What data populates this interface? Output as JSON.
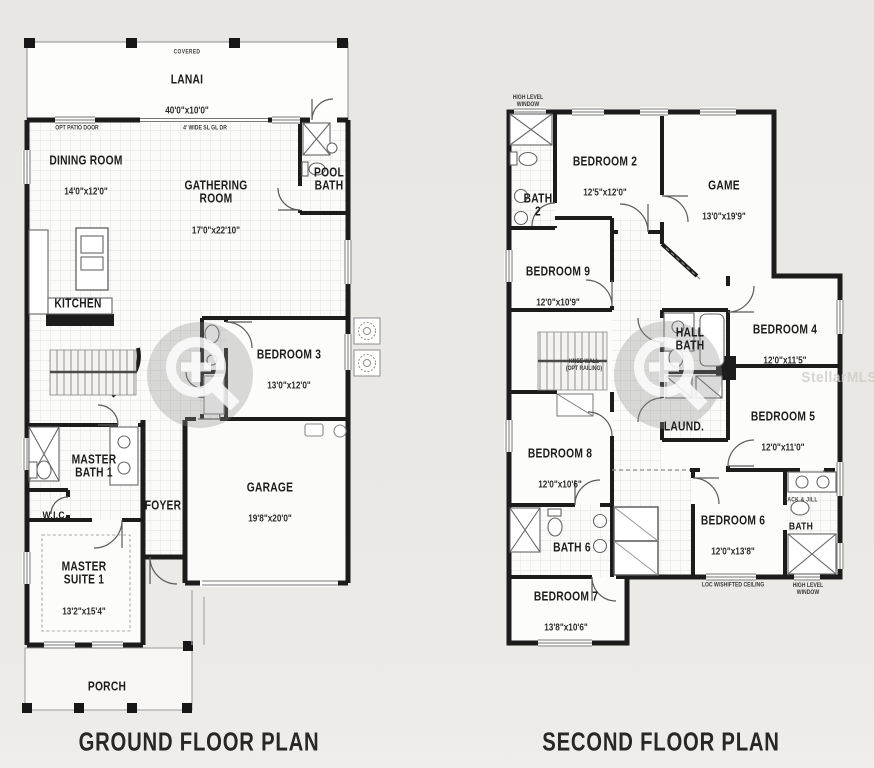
{
  "watermark": {
    "source_label": "StellarMLS"
  },
  "ground_floor": {
    "title": "GROUND FLOOR PLAN",
    "rooms": {
      "lanai": {
        "note": "COVERED",
        "name": "LANAI",
        "dims": "40'0\"x10'0\""
      },
      "dining": {
        "name": "DINING ROOM",
        "dims": "14'0\"x12'0\""
      },
      "gathering": {
        "name": "GATHERING\nROOM",
        "dims": "17'0\"x22'10\""
      },
      "pool_bath": {
        "name": "POOL\nBATH"
      },
      "kitchen": {
        "name": "KITCHEN"
      },
      "bedroom3": {
        "name": "BEDROOM 3",
        "dims": "13'0\"x12'0\""
      },
      "master_bath": {
        "name": "MASTER\nBATH 1"
      },
      "wic": {
        "name": "W.I.C."
      },
      "foyer": {
        "name": "FOYER"
      },
      "garage": {
        "name": "GARAGE",
        "dims": "19'8\"x20'0\""
      },
      "master_suite": {
        "name": "MASTER\nSUITE 1",
        "dims": "13'2\"x15'4\""
      },
      "porch": {
        "name": "PORCH"
      }
    },
    "annotations": {
      "opt_patio_door": "OPT PATIO DOOR",
      "sl_glass_door": "4' WIDE SL GL DR"
    }
  },
  "second_floor": {
    "title": "SECOND FLOOR PLAN",
    "rooms": {
      "bedroom2": {
        "name": "BEDROOM 2",
        "dims": "12'5\"x12'0\""
      },
      "game": {
        "name": "GAME",
        "dims": "13'0\"x19'9\""
      },
      "bath2": {
        "name": "BATH\n2"
      },
      "bedroom9": {
        "name": "BEDROOM 9",
        "dims": "12'0\"x10'9\""
      },
      "hall_bath": {
        "name": "HALL\nBATH"
      },
      "bedroom4": {
        "name": "BEDROOM 4",
        "dims": "12'0\"x11'5\""
      },
      "bedroom5": {
        "name": "BEDROOM 5",
        "dims": "12'0\"x11'0\""
      },
      "laundry": {
        "name": "LAUND."
      },
      "bedroom8": {
        "name": "BEDROOM 8",
        "dims": "12'0\"x10'6\""
      },
      "bath6": {
        "name": "BATH 6"
      },
      "bedroom6": {
        "name": "BEDROOM 6",
        "dims": "12'0\"x13'8\""
      },
      "jack_jill": {
        "label": "JACK & JILL",
        "name": "BATH"
      },
      "bedroom7": {
        "name": "BEDROOM 7",
        "dims": "13'8\"x10'6\""
      }
    },
    "annotations": {
      "high_level_window": "HIGH LEVEL\nWINDOW",
      "knee_wall": "KNEE WALL\n(OPT RAILING)",
      "shifted_ceiling": "LOC W/SHIFTED CEILING",
      "high_level_window_br": "HIGH LEVEL\nWINDOW"
    }
  }
}
